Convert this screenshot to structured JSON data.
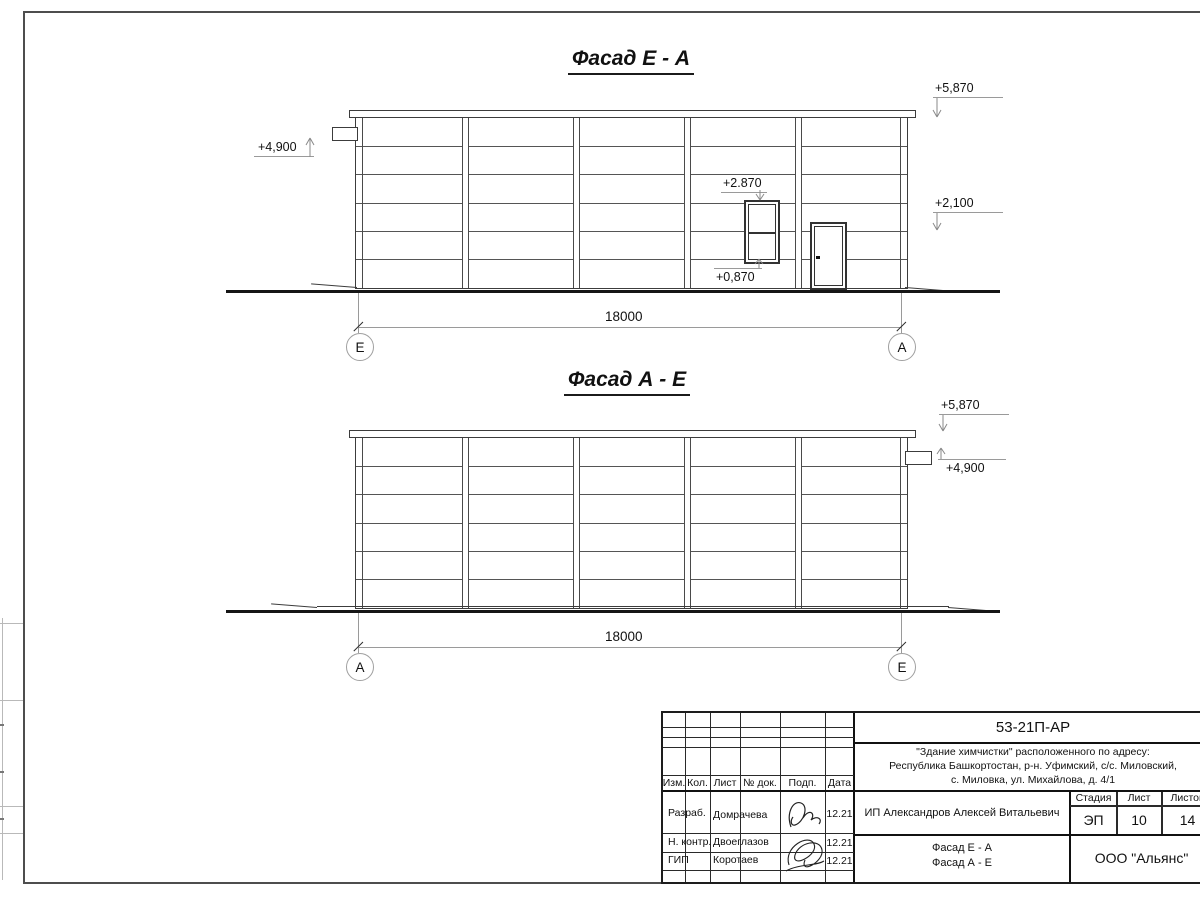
{
  "facade1": {
    "title": "Фасад Е - А",
    "marks": {
      "canopy": "+4,900",
      "roof": "+5,870",
      "level2": "+2,100",
      "window_head": "+2.870",
      "window_sill": "+0,870"
    },
    "dimension": "18000",
    "axis_left": "Е",
    "axis_right": "А"
  },
  "facade2": {
    "title": "Фасад А - Е",
    "marks": {
      "roof": "+5,870",
      "canopy": "+4,900"
    },
    "dimension": "18000",
    "axis_left": "А",
    "axis_right": "Е"
  },
  "title_block": {
    "doc_number": "53-21П-АР",
    "project_address_line1": "\"Здание химчистки\" расположенного по адресу:",
    "project_address_line2": "Республика Башкортостан, р-н. Уфимский, с/с. Миловский,",
    "project_address_line3": "с. Миловка, ул. Михайлова, д. 4/1",
    "col_izm": "Изм.",
    "col_kol": "Кол.",
    "col_list": "Лист",
    "col_doc": "№ док.",
    "col_podp": "Подп.",
    "col_data": "Дата",
    "rows": [
      {
        "role": "Разраб.",
        "name": "Домрачева",
        "date": "12.21"
      },
      {
        "role": "Н. контр.",
        "name": "Двоеглазов",
        "date": "12.21"
      },
      {
        "role": "ГИП",
        "name": "Коротаев",
        "date": "12.21"
      }
    ],
    "client": "ИП Александров Алексей Витальевич",
    "stage_label": "Стадия",
    "list_label": "Лист",
    "listov_label": "Листов",
    "stage_value": "ЭП",
    "list_value": "10",
    "listov_value": "14",
    "drawing_title_line1": "Фасад Е - А",
    "drawing_title_line2": "Фасад А - Е",
    "organization": "ООО \"Альянс\""
  }
}
